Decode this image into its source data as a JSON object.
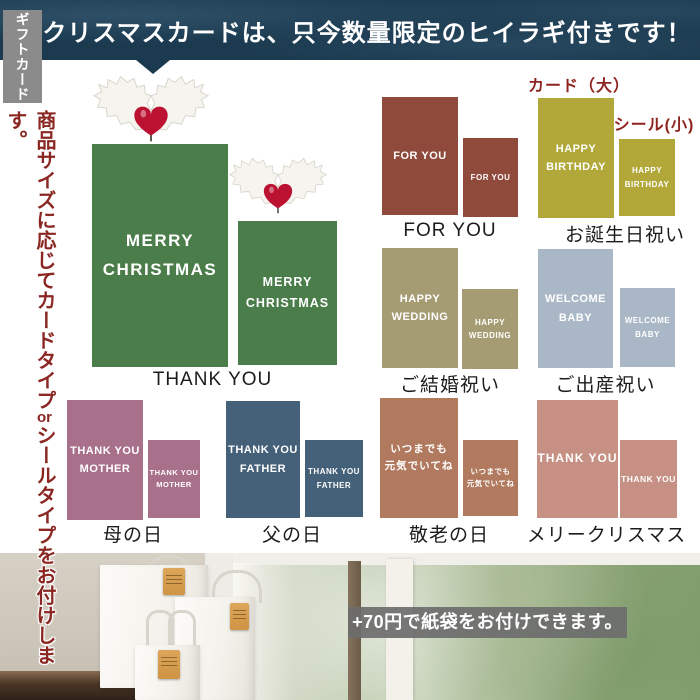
{
  "banner": {
    "title": "クリスマスカードは、只今数量限定のヒイラギ付きです！"
  },
  "sidebar": {
    "tab": "ギフトカード",
    "note_right_a": "商品サイズに応じてカードタイプ",
    "note_right_or": "or",
    "note_right_b": "シールタイプをお付けします。",
    "note_left": "商品の外側か内側にお付けします。当店におまかせください。"
  },
  "annotations": {
    "card_large": "カード（大）",
    "seal_small": "シール(小)"
  },
  "sections": {
    "christmas": {
      "line1": "MERRY",
      "line2": "CHRISTMAS",
      "label": "THANK YOU"
    },
    "foryou": {
      "line1": "FOR YOU",
      "label": "FOR YOU"
    },
    "birthday": {
      "line1": "HAPPY",
      "line2": "BIRTHDAY",
      "label": "お誕生日祝い"
    },
    "wedding": {
      "line1": "HAPPY",
      "line2": "WEDDING",
      "label": "ご結婚祝い"
    },
    "baby": {
      "line1": "WELCOME",
      "line2": "BABY",
      "label": "ご出産祝い"
    },
    "mother": {
      "line1": "THANK YOU",
      "line2": "MOTHER",
      "label": "母の日"
    },
    "father": {
      "line1": "THANK YOU",
      "line2": "FATHER",
      "label": "父の日"
    },
    "keirou": {
      "line1": "いつまでも",
      "line2": "元気でいてね",
      "label": "敬老の日"
    },
    "merry": {
      "line1": "THANK YOU",
      "label": "メリークリスマス"
    }
  },
  "footer": {
    "caption": "+70円で紙袋をお付けできます。"
  },
  "colors": {
    "banner_bg": "#1b3a50",
    "tab_bg": "#8b8b8b",
    "note_red": "#8b2723",
    "annotation_red": "#8e2420",
    "label_text": "#1c1c1c",
    "card_text": "#ffffff",
    "christmas_green": "#4b7d4b",
    "foryou_brick": "#8f4a3b",
    "birthday_mustard": "#b2a83a",
    "wedding_olive": "#a69c74",
    "baby_bluegray": "#a9b7c6",
    "mother_mauve": "#a8708a",
    "father_slate": "#456079",
    "keirou_terracotta": "#b17a5f",
    "merry_pink": "#c69184",
    "caption_bg": "#6c6c6c",
    "tag_orange": "#d49a4f",
    "holly_red": "#bb1231"
  }
}
